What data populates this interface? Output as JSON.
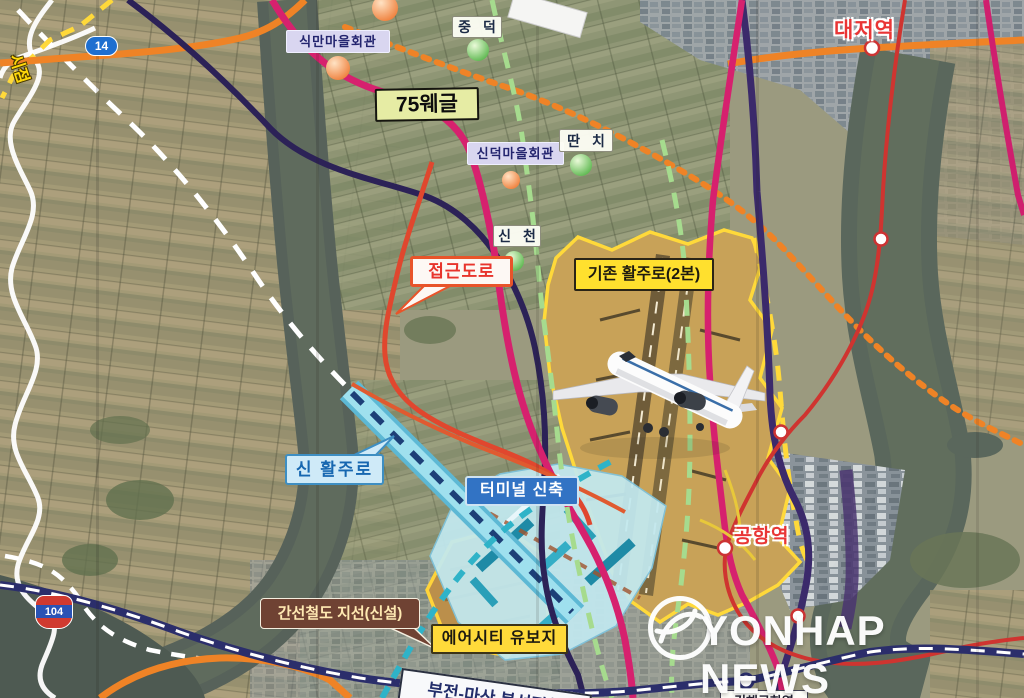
{
  "watermark": {
    "text": "YONHAP NEWS"
  },
  "route_shields": {
    "national_14": "14",
    "national_104": "104"
  },
  "map_labels": {
    "sikman_hall": "식만마을회관",
    "jungdeok": "중 덕",
    "area_75": "75웨글",
    "sindeok_hall": "신덕마을회관",
    "ttanchi": "딴 치",
    "daejeo_station": "대저역",
    "sincheon": "신 천",
    "access_road": "접근도로",
    "existing_runway": "기존 활주로(2본)",
    "new_runway": "신 활주로",
    "terminal_new": "터미널 신축",
    "trunk_rail_branch": "간선철도 지선(신설)",
    "aircity_reserve": "에어시티 유보지",
    "airport_station": "공항역",
    "bujeon_masan_line": "부전-마산 복선전철",
    "gimhae_airport_station_partial": "김해공항역",
    "start_point": "시점"
  },
  "legend_colors": {
    "orange_road": "#ef8326",
    "orange_dotted_planned_road": "#ef8326",
    "magenta_light_rail": "#d6216e",
    "navy_expressway": "#3b2a6b",
    "green_dashed_route": "#a6db8e",
    "yellow_airport_boundary": "#ffd93a",
    "red_rail_with_stations": "#cf3430",
    "red_access_road": "#e0472e",
    "cyan_new_runway": "#8edceb",
    "teal_rail_branch": "#2fb3c8",
    "white_boundary": "#ffffff",
    "navy_white_dashed_rail": "#2b2e6b"
  }
}
